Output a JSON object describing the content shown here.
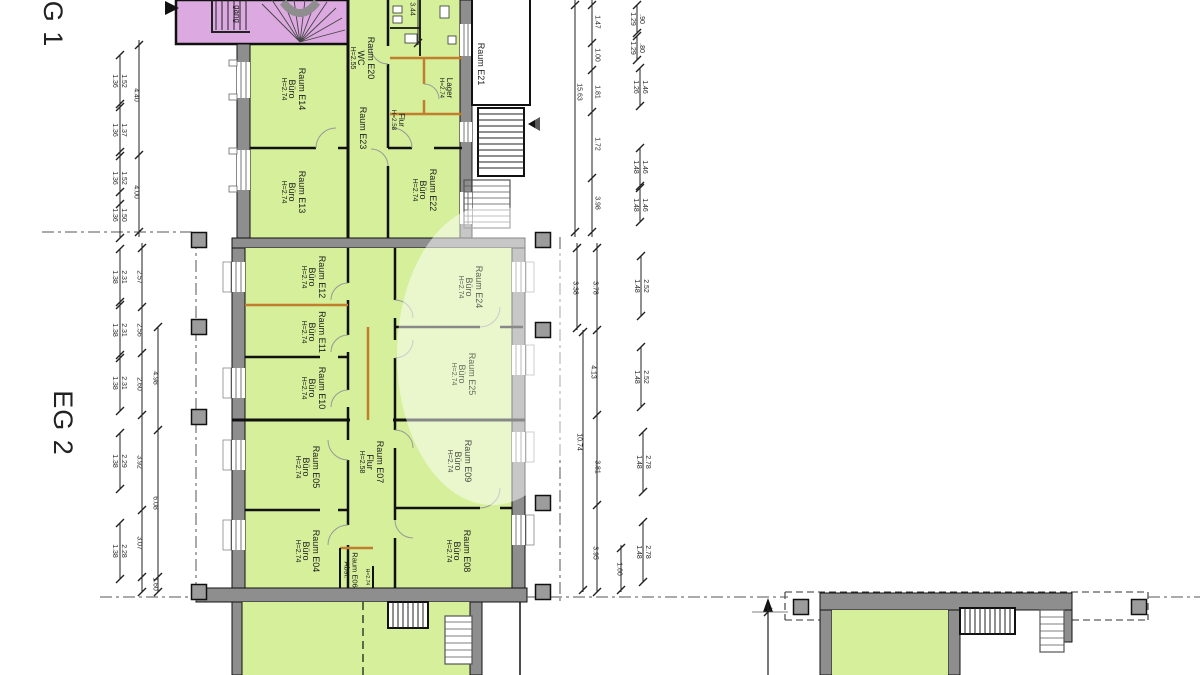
{
  "document": {
    "kind": "architectural floor plan",
    "background": "#ffffff"
  },
  "sections": {
    "eg1_label": "G 1",
    "eg2_label": "EG 2"
  },
  "colors": {
    "room_fill": "#d5ef9a",
    "stairwell_fill": "#dcaae1",
    "wall_gray": "#8e8e8e",
    "column_gray": "#9c9c9c",
    "partition_wood": "#c17f2e",
    "line": "#111111",
    "dim_text": "#2a2a2a",
    "watermark": "#ffffff"
  },
  "plan": {
    "room_labels": [
      {
        "id": "stairwell",
        "lines": [
          "gang"
        ],
        "cx": 236,
        "cy": 14,
        "fs": 8
      },
      {
        "id": "e14",
        "lines": [
          "Raum E14",
          "Büro",
          "H=2.74"
        ],
        "cx": 293,
        "cy": 89
      },
      {
        "id": "e13",
        "lines": [
          "Raum E13",
          "Büro",
          "H=2.74"
        ],
        "cx": 293,
        "cy": 192
      },
      {
        "id": "e20",
        "lines": [
          "Raum E20",
          "WC",
          "H=2.55"
        ],
        "cx": 362,
        "cy": 58
      },
      {
        "id": "e23",
        "lines": [
          "Raum E23"
        ],
        "cx": 363,
        "cy": 128
      },
      {
        "id": "e23-flur",
        "lines": [
          "Flur",
          "H=2.58"
        ],
        "cx": 397,
        "cy": 120,
        "fs": 8
      },
      {
        "id": "lager",
        "lines": [
          "Lager",
          "H=2.74"
        ],
        "cx": 445,
        "cy": 88,
        "fs": 8
      },
      {
        "id": "e22",
        "lines": [
          "Raum E22",
          "Büro",
          "H=2.74"
        ],
        "cx": 424,
        "cy": 190
      },
      {
        "id": "e21",
        "lines": [
          "Raum E21"
        ],
        "cx": 481,
        "cy": 64
      },
      {
        "id": "e12",
        "lines": [
          "Raum E12",
          "Büro",
          "H=2.74"
        ],
        "cx": 313,
        "cy": 277
      },
      {
        "id": "e11",
        "lines": [
          "Raum E11",
          "Büro",
          "H=2.74"
        ],
        "cx": 313,
        "cy": 332
      },
      {
        "id": "e10",
        "lines": [
          "Raum E10",
          "Büro",
          "H=2.74"
        ],
        "cx": 313,
        "cy": 388
      },
      {
        "id": "e24",
        "lines": [
          "Raum E24",
          "Büro",
          "H=2.74"
        ],
        "cx": 470,
        "cy": 287,
        "op": 0.7
      },
      {
        "id": "e25",
        "lines": [
          "Raum E25",
          "Büro",
          "H=2.74"
        ],
        "cx": 463,
        "cy": 374,
        "op": 0.65
      },
      {
        "id": "e05",
        "lines": [
          "Raum E05",
          "Büro",
          "H=2.74"
        ],
        "cx": 307,
        "cy": 467
      },
      {
        "id": "e07",
        "lines": [
          "Raum E07",
          "Flur",
          "H=2.58"
        ],
        "cx": 371,
        "cy": 462
      },
      {
        "id": "e09",
        "lines": [
          "Raum E09",
          "Büro",
          "H=2.74"
        ],
        "cx": 459,
        "cy": 461,
        "op": 0.8
      },
      {
        "id": "e04",
        "lines": [
          "Raum E04",
          "Büro",
          "H=2.74"
        ],
        "cx": 307,
        "cy": 551
      },
      {
        "id": "e06",
        "lines": [
          "Raum E06",
          "Abst."
        ],
        "cx": 350,
        "cy": 570,
        "fs": 7.5
      },
      {
        "id": "e06-h",
        "lines": [
          "H=2.74"
        ],
        "cx": 366,
        "cy": 577,
        "fs": 6.5
      },
      {
        "id": "e08",
        "lines": [
          "Raum E08",
          "Büro",
          "H=2.74"
        ],
        "cx": 458,
        "cy": 551
      }
    ],
    "dim_labels": [
      {
        "lines": [
          "1.52",
          "1.36"
        ],
        "cx": 118,
        "cy": 81
      },
      {
        "lines": [
          "1.37",
          "1.36"
        ],
        "cx": 118,
        "cy": 130
      },
      {
        "lines": [
          "1.52",
          "1.36"
        ],
        "cx": 118,
        "cy": 178
      },
      {
        "lines": [
          "1.50",
          "1.36"
        ],
        "cx": 118,
        "cy": 215
      },
      {
        "lines": [
          "4.40"
        ],
        "cx": 135,
        "cy": 95
      },
      {
        "lines": [
          "4.00"
        ],
        "cx": 135,
        "cy": 192
      },
      {
        "lines": [
          "3.44"
        ],
        "cx": 411,
        "cy": 9
      },
      {
        "lines": [
          "15.63"
        ],
        "cx": 578,
        "cy": 92
      },
      {
        "lines": [
          "1.47"
        ],
        "cx": 596,
        "cy": 22
      },
      {
        "lines": [
          "1.00"
        ],
        "cx": 596,
        "cy": 55
      },
      {
        "lines": [
          "1.81"
        ],
        "cx": 596,
        "cy": 92
      },
      {
        "lines": [
          "1.72"
        ],
        "cx": 596,
        "cy": 144
      },
      {
        "lines": [
          "3.98"
        ],
        "cx": 596,
        "cy": 203
      },
      {
        "lines": [
          ".90",
          "1.29"
        ],
        "cx": 636,
        "cy": 19
      },
      {
        "lines": [
          ".80",
          "1.29"
        ],
        "cx": 636,
        "cy": 48
      },
      {
        "lines": [
          "1.46",
          "1.26"
        ],
        "cx": 639,
        "cy": 87
      },
      {
        "lines": [
          "1.46",
          "1.48"
        ],
        "cx": 639,
        "cy": 167
      },
      {
        "lines": [
          "1.46",
          "1.48"
        ],
        "cx": 639,
        "cy": 205
      },
      {
        "lines": [
          "2.31",
          "1.38"
        ],
        "cx": 118,
        "cy": 277
      },
      {
        "lines": [
          "2.31",
          "1.38"
        ],
        "cx": 118,
        "cy": 330
      },
      {
        "lines": [
          "2.31",
          "1.38"
        ],
        "cx": 118,
        "cy": 383
      },
      {
        "lines": [
          "2.29",
          "1.38"
        ],
        "cx": 118,
        "cy": 461
      },
      {
        "lines": [
          "2.28",
          "1.38"
        ],
        "cx": 118,
        "cy": 551
      },
      {
        "lines": [
          "2.57"
        ],
        "cx": 138,
        "cy": 277
      },
      {
        "lines": [
          "2.56"
        ],
        "cx": 138,
        "cy": 330
      },
      {
        "lines": [
          "2.60"
        ],
        "cx": 138,
        "cy": 384
      },
      {
        "lines": [
          "3.92"
        ],
        "cx": 138,
        "cy": 462
      },
      {
        "lines": [
          "3.07"
        ],
        "cx": 138,
        "cy": 543
      },
      {
        "lines": [
          "4.98"
        ],
        "cx": 154,
        "cy": 378
      },
      {
        "lines": [
          "6.08"
        ],
        "cx": 154,
        "cy": 503
      },
      {
        "lines": [
          "1.60"
        ],
        "cx": 154,
        "cy": 584
      },
      {
        "lines": [
          "3.38"
        ],
        "cx": 574,
        "cy": 288
      },
      {
        "lines": [
          "3.78"
        ],
        "cx": 594,
        "cy": 288
      },
      {
        "lines": [
          "4.13"
        ],
        "cx": 592,
        "cy": 372
      },
      {
        "lines": [
          "10.74"
        ],
        "cx": 578,
        "cy": 442
      },
      {
        "lines": [
          "3.81"
        ],
        "cx": 596,
        "cy": 467
      },
      {
        "lines": [
          "3.95"
        ],
        "cx": 594,
        "cy": 553
      },
      {
        "lines": [
          "1.60"
        ],
        "cx": 618,
        "cy": 569
      },
      {
        "lines": [
          "2.52",
          "1.48"
        ],
        "cx": 640,
        "cy": 286
      },
      {
        "lines": [
          "2.52",
          "1.48"
        ],
        "cx": 640,
        "cy": 377
      },
      {
        "lines": [
          "2.78",
          "1.48"
        ],
        "cx": 642,
        "cy": 462
      },
      {
        "lines": [
          "2.78",
          "1.48"
        ],
        "cx": 642,
        "cy": 552
      }
    ],
    "columns": [
      [
        199,
        240
      ],
      [
        199,
        327
      ],
      [
        199,
        417
      ],
      [
        199,
        592
      ],
      [
        543,
        240
      ],
      [
        543,
        330
      ],
      [
        543,
        503
      ],
      [
        543,
        592
      ],
      [
        801,
        607
      ],
      [
        1139,
        607
      ]
    ],
    "dim_lines": [
      {
        "x": 139,
        "y1": 40,
        "y2": 237,
        "ticks": [
          45,
          155,
          232
        ]
      },
      {
        "x": 120,
        "y1": 55,
        "y2": 107,
        "ticks": [
          55,
          107
        ]
      },
      {
        "x": 120,
        "y1": 104,
        "y2": 156,
        "ticks": [
          104,
          156
        ]
      },
      {
        "x": 120,
        "y1": 152,
        "y2": 204,
        "ticks": [
          152,
          204
        ]
      },
      {
        "x": 120,
        "y1": 192,
        "y2": 238,
        "ticks": [
          192,
          238
        ]
      },
      {
        "x": 418,
        "y1": 0,
        "y2": 45,
        "ticks": [
          43
        ]
      },
      {
        "x": 575,
        "y1": 0,
        "y2": 237,
        "ticks": [
          5,
          232
        ]
      },
      {
        "x": 592,
        "y1": 0,
        "y2": 237,
        "ticks": [
          5,
          43,
          70,
          112,
          178,
          232
        ]
      },
      {
        "x": 637,
        "y1": 5,
        "y2": 33,
        "ticks": [
          5,
          33
        ]
      },
      {
        "x": 637,
        "y1": 36,
        "y2": 60,
        "ticks": [
          36,
          60
        ]
      },
      {
        "x": 640,
        "y1": 68,
        "y2": 106,
        "ticks": [
          68,
          106
        ]
      },
      {
        "x": 640,
        "y1": 148,
        "y2": 186,
        "ticks": [
          148,
          186
        ]
      },
      {
        "x": 640,
        "y1": 188,
        "y2": 222,
        "ticks": [
          188,
          222
        ]
      },
      {
        "x": 142,
        "y1": 243,
        "y2": 592,
        "ticks": [
          248,
          307,
          353,
          415,
          510,
          577,
          592
        ]
      },
      {
        "x": 120,
        "y1": 249,
        "y2": 305,
        "ticks": [
          249,
          305
        ]
      },
      {
        "x": 120,
        "y1": 302,
        "y2": 358,
        "ticks": [
          302,
          358
        ]
      },
      {
        "x": 120,
        "y1": 355,
        "y2": 411,
        "ticks": [
          355,
          411
        ]
      },
      {
        "x": 120,
        "y1": 433,
        "y2": 489,
        "ticks": [
          433,
          489
        ]
      },
      {
        "x": 120,
        "y1": 523,
        "y2": 579,
        "ticks": [
          523,
          579
        ]
      },
      {
        "x": 158,
        "y1": 327,
        "y2": 592,
        "ticks": [
          327,
          430,
          577,
          592
        ]
      },
      {
        "x": 577,
        "y1": 243,
        "y2": 330,
        "ticks": [
          248,
          328
        ]
      },
      {
        "x": 597,
        "y1": 243,
        "y2": 592,
        "ticks": [
          248,
          330,
          415,
          505,
          592
        ]
      },
      {
        "x": 583,
        "y1": 330,
        "y2": 592,
        "ticks": [
          332,
          590
        ]
      },
      {
        "x": 621,
        "y1": 545,
        "y2": 592,
        "ticks": [
          548,
          590
        ]
      },
      {
        "x": 641,
        "y1": 256,
        "y2": 316,
        "ticks": [
          256,
          316
        ]
      },
      {
        "x": 641,
        "y1": 347,
        "y2": 407,
        "ticks": [
          347,
          407
        ]
      },
      {
        "x": 643,
        "y1": 432,
        "y2": 492,
        "ticks": [
          432,
          492
        ]
      },
      {
        "x": 643,
        "y1": 522,
        "y2": 582,
        "ticks": [
          522,
          582
        ]
      },
      {
        "x": 768,
        "y1": 604,
        "y2": 675,
        "ticks": [
          612
        ]
      }
    ]
  }
}
